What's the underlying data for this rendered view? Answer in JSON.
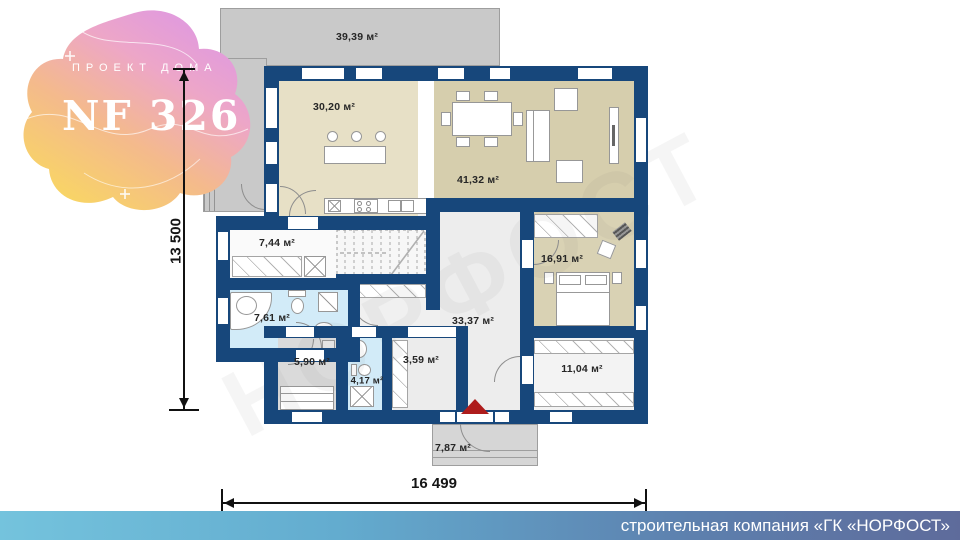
{
  "logo": {
    "kicker": "ПРОЕКТ ДОМА",
    "title": "NF 326"
  },
  "plan": {
    "rooms": [
      {
        "id": "terrace",
        "area_label": "39,39 м²"
      },
      {
        "id": "kitchen",
        "area_label": "30,20 м²"
      },
      {
        "id": "living-room",
        "area_label": "41,32 м²"
      },
      {
        "id": "hallway",
        "area_label": "7,44 м²"
      },
      {
        "id": "bedroom",
        "area_label": "16,91 м²"
      },
      {
        "id": "bathroom",
        "area_label": "7,61 м²"
      },
      {
        "id": "hall",
        "area_label": "33,37 м²"
      },
      {
        "id": "sauna",
        "area_label": "5,90 м²"
      },
      {
        "id": "wc",
        "area_label": "4,17 м²"
      },
      {
        "id": "corridor",
        "area_label": "3,59 м²"
      },
      {
        "id": "dressing-room",
        "area_label": "11,04 м²"
      },
      {
        "id": "porch",
        "area_label": "7,87 м²"
      }
    ],
    "dimensions": {
      "horizontal": "16 499",
      "vertical": "13 500"
    }
  },
  "watermark": "НОРФОСТ",
  "footer": {
    "company_line": "строительная компания «ГК «НОРФОСТ»"
  },
  "colors": {
    "wall": "#17477b",
    "terrace_gray": "#c9c9c9",
    "kitchen_beige": "#e7e0c6",
    "living_tan": "#d6cead",
    "bedroom_tan": "#d9d2b4",
    "bath_blue": "#d2ebf8",
    "entrance_red": "#ae1c1c",
    "banner_left": "#74c3dd",
    "banner_right": "#5e6b9b"
  }
}
